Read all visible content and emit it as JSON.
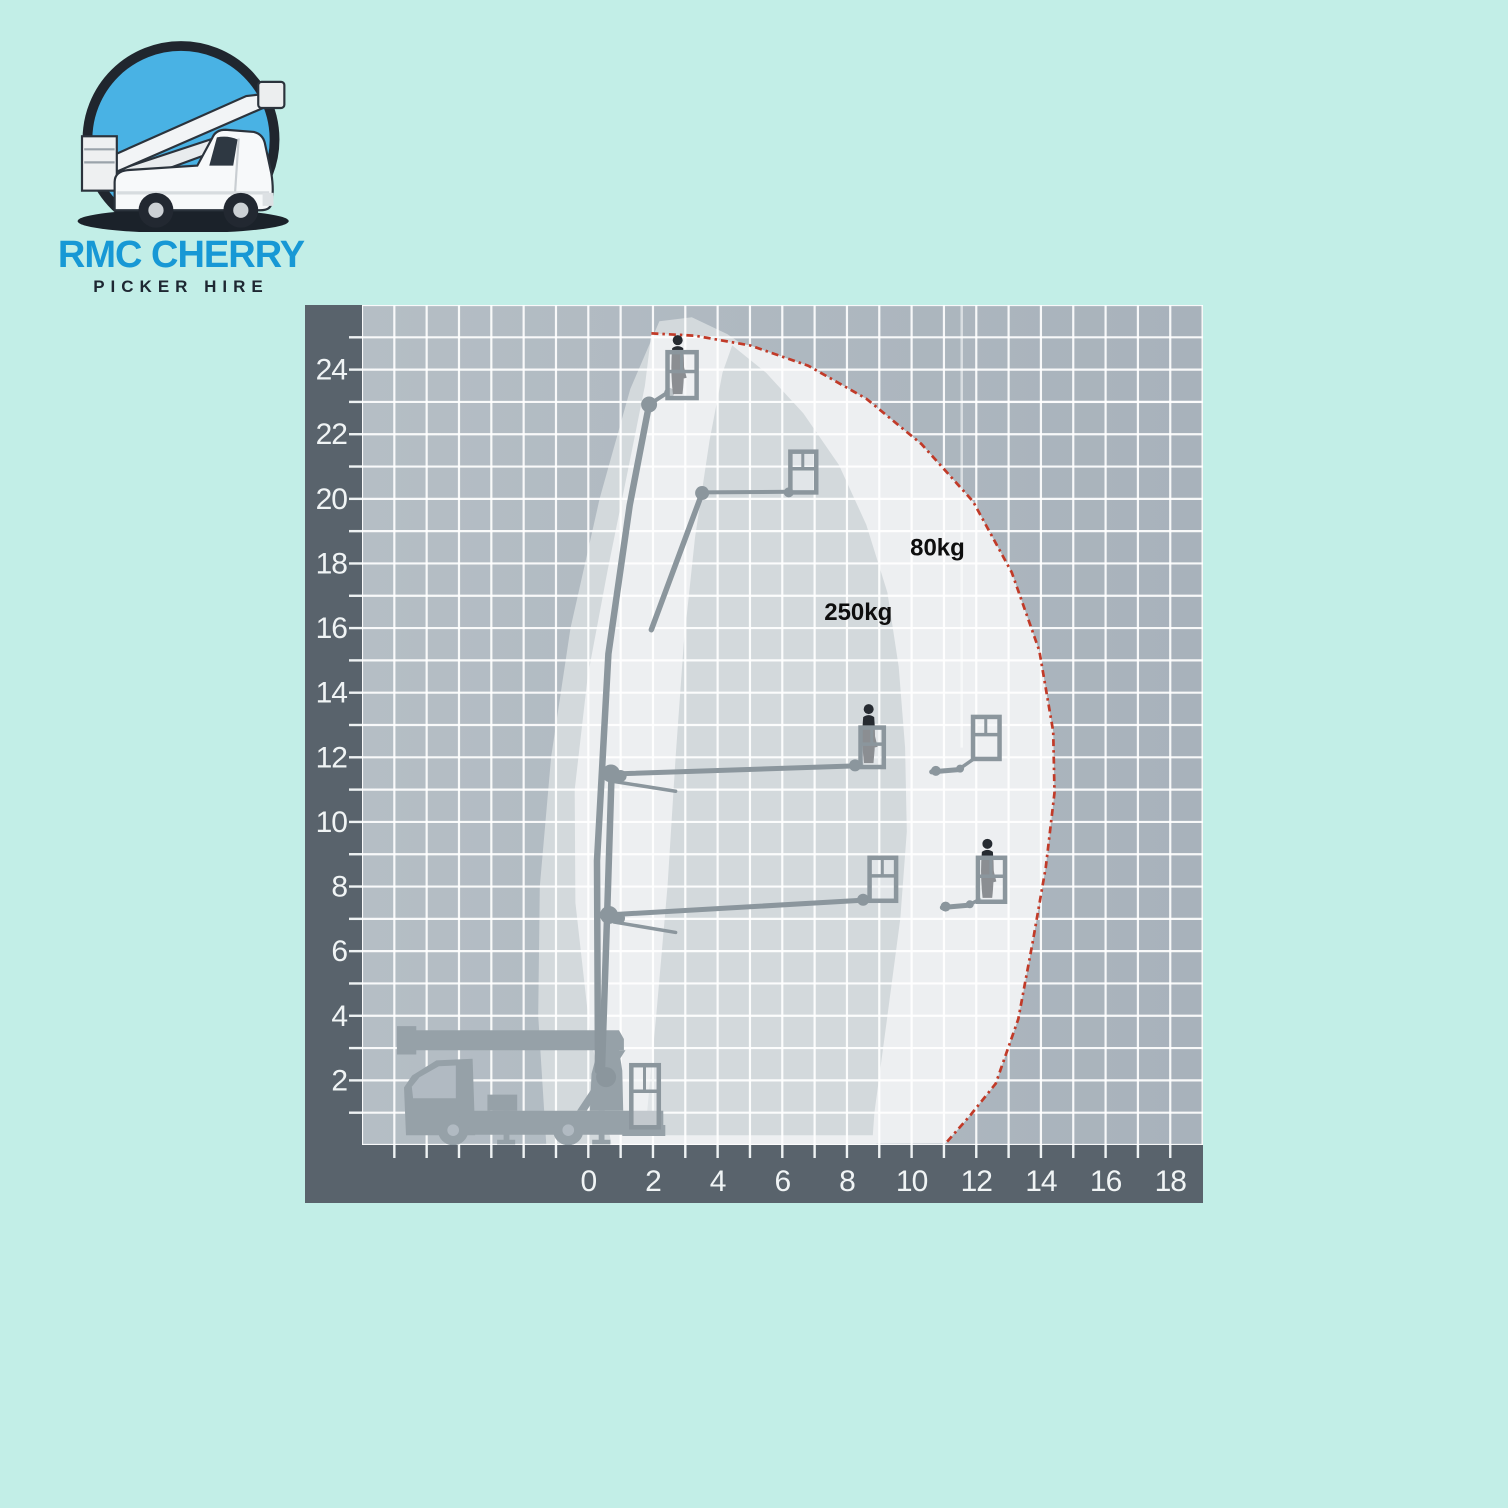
{
  "page": {
    "background": "#c2eee7"
  },
  "logo": {
    "line1": "RMC CHERRY",
    "line2": "PICKER HIRE",
    "line1_color": "#1798d5",
    "line2_color": "#1e2732",
    "circle_fill": "#49b2e4",
    "circle_ring": "#20262e"
  },
  "chart_data": {
    "type": "area",
    "title": "",
    "description": "Cherry picker working envelope diagram: working height (m) vs outreach (m) with 250kg and 80kg basket-load zones",
    "xlabel": "",
    "ylabel": "",
    "x_tick_labels": [
      "0",
      "2",
      "4",
      "6",
      "8",
      "10",
      "12",
      "14",
      "16",
      "18"
    ],
    "y_tick_labels": [
      "2",
      "4",
      "6",
      "8",
      "10",
      "12",
      "14",
      "16",
      "18",
      "20",
      "22",
      "24"
    ],
    "x_range": [
      -7,
      19
    ],
    "y_range": [
      0,
      26
    ],
    "grid": true,
    "annotations": [
      {
        "text": "80kg",
        "x": 10.8,
        "y": 18.5
      },
      {
        "text": "250kg",
        "x": 8.35,
        "y": 16.5
      }
    ],
    "regions": {
      "envelope_250kg": [
        [
          -1.3,
          0
        ],
        [
          -1.55,
          4
        ],
        [
          -1.5,
          8
        ],
        [
          -1.15,
          12
        ],
        [
          -0.55,
          16
        ],
        [
          0.35,
          20
        ],
        [
          1.3,
          23.4
        ],
        [
          2.2,
          25.5
        ],
        [
          3.2,
          25.62
        ],
        [
          4.3,
          25.1
        ],
        [
          5.6,
          24.2
        ],
        [
          6.8,
          23.0
        ],
        [
          7.9,
          21.4
        ],
        [
          8.8,
          19.5
        ],
        [
          9.45,
          17.4
        ],
        [
          9.8,
          15.0
        ],
        [
          10.0,
          12.4
        ],
        [
          10.05,
          9.8
        ],
        [
          9.85,
          7.0
        ],
        [
          9.4,
          3.5
        ],
        [
          9.0,
          0.9
        ],
        [
          8.9,
          0
        ]
      ],
      "envelope_80kg_outer": [
        [
          0.72,
          0
        ],
        [
          0.05,
          3.5
        ],
        [
          -0.4,
          7.5
        ],
        [
          -0.42,
          11
        ],
        [
          -0.02,
          14.5
        ],
        [
          0.6,
          17.8
        ],
        [
          1.25,
          21.0
        ],
        [
          1.75,
          23.5
        ],
        [
          1.95,
          25.12
        ],
        [
          3.3,
          25.05
        ],
        [
          5.0,
          24.75
        ],
        [
          6.8,
          24.12
        ],
        [
          8.6,
          23.1
        ],
        [
          10.3,
          21.7
        ],
        [
          11.9,
          19.92
        ],
        [
          13.1,
          17.72
        ],
        [
          13.95,
          15.3
        ],
        [
          14.38,
          12.8
        ],
        [
          14.42,
          10.9
        ],
        [
          14.15,
          8.6
        ],
        [
          13.75,
          6.3
        ],
        [
          13.3,
          3.9
        ],
        [
          12.6,
          1.9
        ],
        [
          11.8,
          0.9
        ],
        [
          11.05,
          0.05
        ]
      ],
      "envelope_80kg_cutout": [
        [
          1.75,
          0.3
        ],
        [
          2.1,
          4.0
        ],
        [
          2.45,
          8.0
        ],
        [
          2.7,
          12.0
        ],
        [
          2.95,
          15.5
        ],
        [
          3.3,
          18.8
        ],
        [
          3.75,
          21.8
        ],
        [
          4.15,
          23.9
        ],
        [
          4.45,
          24.75
        ],
        [
          5.5,
          23.9
        ],
        [
          6.65,
          22.65
        ],
        [
          7.75,
          21.05
        ],
        [
          8.6,
          19.2
        ],
        [
          9.25,
          17.1
        ],
        [
          9.6,
          14.8
        ],
        [
          9.8,
          12.3
        ],
        [
          9.85,
          9.7
        ],
        [
          9.65,
          7.0
        ],
        [
          9.2,
          3.6
        ],
        [
          8.85,
          1.0
        ],
        [
          8.8,
          0.3
        ]
      ]
    },
    "boundary_80kg": [
      [
        1.95,
        25.12
      ],
      [
        3.3,
        25.05
      ],
      [
        5.0,
        24.75
      ],
      [
        6.8,
        24.12
      ],
      [
        8.6,
        23.1
      ],
      [
        10.3,
        21.7
      ],
      [
        11.9,
        19.92
      ],
      [
        13.1,
        17.72
      ],
      [
        13.95,
        15.3
      ],
      [
        14.38,
        12.8
      ],
      [
        14.42,
        10.9
      ],
      [
        14.15,
        8.6
      ],
      [
        13.75,
        6.3
      ],
      [
        13.3,
        3.9
      ],
      [
        12.6,
        1.9
      ],
      [
        11.8,
        0.9
      ],
      [
        11.05,
        0.05
      ]
    ],
    "masts": [
      {
        "pts": [
          [
            0.3,
            2.3
          ],
          [
            0.27,
            8.8
          ],
          [
            0.62,
            15.2
          ],
          [
            1.28,
            19.8
          ],
          [
            1.88,
            22.92
          ]
        ],
        "w": 6.5
      },
      {
        "pts": [
          [
            0.42,
            2.3
          ],
          [
            0.58,
            7.1
          ],
          [
            0.72,
            11.5
          ]
        ],
        "w": 6.5
      }
    ],
    "booms": [
      [
        1.88,
        22.92,
        2.5,
        23.32,
        4
      ],
      [
        1.95,
        15.95,
        3.52,
        20.18,
        5.5
      ],
      [
        3.52,
        20.2,
        6.28,
        20.22,
        4
      ],
      [
        0.62,
        11.48,
        8.15,
        11.73,
        5
      ],
      [
        0.8,
        11.25,
        2.7,
        10.95,
        3.5
      ],
      [
        8.15,
        11.73,
        8.45,
        11.8,
        4
      ],
      [
        10.62,
        11.55,
        11.45,
        11.62,
        5
      ],
      [
        11.45,
        11.62,
        11.92,
        11.95,
        3.5
      ],
      [
        0.58,
        7.12,
        8.4,
        7.57,
        5
      ],
      [
        0.8,
        6.9,
        2.7,
        6.58,
        3.5
      ],
      [
        8.4,
        7.57,
        8.7,
        7.63,
        4
      ],
      [
        10.95,
        7.35,
        11.75,
        7.42,
        5
      ],
      [
        11.75,
        7.42,
        12.1,
        7.6,
        3.5
      ]
    ],
    "knuckles": [
      [
        1.88,
        22.92,
        8
      ],
      [
        2.5,
        23.28,
        5
      ],
      [
        3.52,
        20.18,
        7
      ],
      [
        6.2,
        20.2,
        5
      ],
      [
        0.7,
        11.5,
        9
      ],
      [
        1.0,
        11.42,
        6
      ],
      [
        8.25,
        11.75,
        6
      ],
      [
        10.75,
        11.58,
        5
      ],
      [
        11.5,
        11.65,
        4
      ],
      [
        0.64,
        7.12,
        9
      ],
      [
        0.95,
        7.02,
        6
      ],
      [
        8.5,
        7.59,
        6
      ],
      [
        11.05,
        7.38,
        5
      ],
      [
        11.8,
        7.45,
        4
      ],
      [
        0.55,
        2.1,
        10
      ]
    ],
    "baskets": [
      {
        "x": 2.45,
        "y": 23.12,
        "w": 0.9,
        "h": 1.42,
        "person": true
      },
      {
        "x": 6.25,
        "y": 20.2,
        "w": 0.8,
        "h": 1.26,
        "person": false
      },
      {
        "x": 8.42,
        "y": 11.7,
        "w": 0.72,
        "h": 1.22,
        "person": true
      },
      {
        "x": 11.9,
        "y": 11.95,
        "w": 0.82,
        "h": 1.3,
        "person": false
      },
      {
        "x": 8.7,
        "y": 7.56,
        "w": 0.82,
        "h": 1.33,
        "person": false
      },
      {
        "x": 12.05,
        "y": 7.53,
        "w": 0.84,
        "h": 1.36,
        "person": true
      }
    ],
    "truck": {
      "polys": [
        [
          [
            -5.92,
            2.8
          ],
          [
            -5.92,
            3.68
          ],
          [
            -5.32,
            3.68
          ],
          [
            -5.32,
            2.8
          ]
        ],
        [
          [
            -5.78,
            2.93
          ],
          [
            -5.78,
            3.55
          ],
          [
            0.95,
            3.55
          ],
          [
            1.1,
            3.28
          ],
          [
            1.1,
            2.93
          ]
        ],
        [
          [
            -5.64,
            0.3
          ],
          [
            -5.7,
            1.78
          ],
          [
            -5.45,
            2.15
          ],
          [
            -4.7,
            2.62
          ],
          [
            -3.58,
            2.67
          ],
          [
            -3.5,
            0.3
          ]
        ],
        [
          [
            -3.55,
            0.32
          ],
          [
            -3.55,
            1.06
          ],
          [
            2.32,
            1.06
          ],
          [
            2.32,
            0.32
          ]
        ],
        [
          [
            -3.12,
            1.06
          ],
          [
            -3.12,
            1.56
          ],
          [
            -2.2,
            1.56
          ],
          [
            -2.2,
            1.06
          ]
        ],
        [
          [
            0.05,
            1.06
          ],
          [
            0.1,
            2.2
          ],
          [
            0.3,
            2.95
          ],
          [
            0.95,
            2.95
          ],
          [
            1.05,
            2.3
          ],
          [
            1.08,
            1.06
          ]
        ],
        [
          [
            -0.35,
            1.06
          ],
          [
            0.9,
            2.93
          ],
          [
            1.15,
            2.93
          ],
          [
            -0.05,
            1.06
          ]
        ],
        [
          [
            1.05,
            0.28
          ],
          [
            1.05,
            0.62
          ],
          [
            2.38,
            0.62
          ],
          [
            2.38,
            0.28
          ]
        ],
        [
          [
            -2.62,
            0.1
          ],
          [
            -2.62,
            1.06
          ],
          [
            -2.44,
            1.06
          ],
          [
            -2.44,
            0.1
          ]
        ],
        [
          [
            -2.82,
            0.02
          ],
          [
            -2.82,
            0.16
          ],
          [
            -2.26,
            0.16
          ],
          [
            -2.26,
            0.02
          ]
        ],
        [
          [
            0.32,
            0.1
          ],
          [
            0.32,
            1.06
          ],
          [
            0.5,
            1.06
          ],
          [
            0.5,
            0.1
          ]
        ],
        [
          [
            0.12,
            0.02
          ],
          [
            0.12,
            0.16
          ],
          [
            0.68,
            0.16
          ],
          [
            0.68,
            0.02
          ]
        ]
      ],
      "window": [
        [
          -5.42,
          1.45
        ],
        [
          -5.46,
          1.8
        ],
        [
          -5.22,
          2.1
        ],
        [
          -4.62,
          2.44
        ],
        [
          -4.1,
          2.46
        ],
        [
          -4.1,
          1.45
        ]
      ],
      "wheels": [
        [
          -4.18,
          0.46,
          0.47
        ],
        [
          -0.62,
          0.46,
          0.47
        ]
      ],
      "travel_basket": {
        "x": 1.33,
        "y": 0.55,
        "w": 0.85,
        "h": 1.92
      }
    },
    "artifacts": {
      "vline": {
        "x": 11.55,
        "y1": 26,
        "y2": 12.3
      },
      "hline": {
        "y": 23.0,
        "x1": 11.55,
        "x2": 19
      }
    },
    "colors": {
      "band": "#59636c",
      "grid_bg_left": "#b5bec5",
      "grid_bg_right": "#a8b2bb",
      "gridline": "rgba(255,255,255,0.9)",
      "region_250": "#d3d9dc",
      "region_80": "#edeff1",
      "boundary": "#c13a28",
      "machine": "#8b969d",
      "truck": "#96a1a8",
      "truck_window": "#b1bac2",
      "person": "#262b31",
      "tick_text": "#f0f4f5",
      "annotation_text": "#0e0e0e"
    },
    "layout": {
      "px_per_unit": 32.33,
      "grid_left": 57,
      "ground_y": 840,
      "band_bottom_h": 58,
      "svg_w": 898,
      "svg_h": 898
    }
  }
}
